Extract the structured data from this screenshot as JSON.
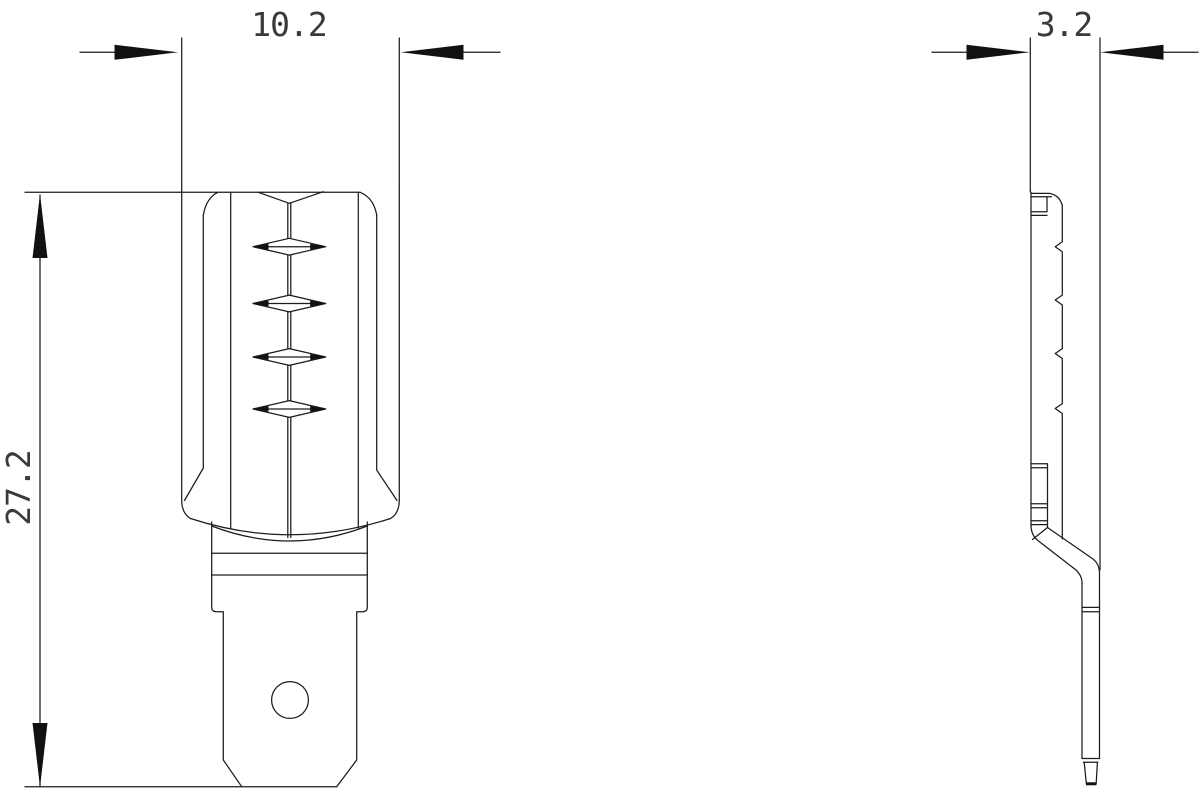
{
  "drawing": {
    "type": "engineering-drawing-two-views",
    "colors": {
      "background": "#ffffff",
      "line": "#1c1c1c",
      "arrow": "#111111",
      "text": "#3a3a3a"
    },
    "dimensions": {
      "width_top": {
        "label": "10.2"
      },
      "height_left": {
        "label": "27.2"
      },
      "thickness_side": {
        "label": "3.2"
      }
    }
  }
}
